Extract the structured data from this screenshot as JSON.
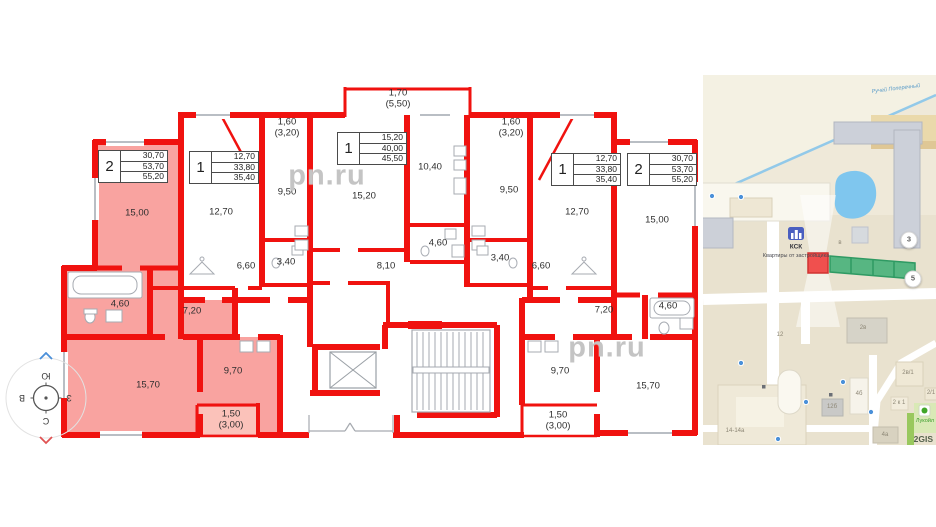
{
  "plan": {
    "watermark": "pn.ru",
    "apartments": [
      {
        "num": "2",
        "rows": [
          "30,70",
          "53,70",
          "55,20"
        ],
        "x": 98,
        "y": 150
      },
      {
        "num": "1",
        "rows": [
          "12,70",
          "33,80",
          "35,40"
        ],
        "x": 189,
        "y": 151
      },
      {
        "num": "1",
        "rows": [
          "15,20",
          "40,00",
          "45,50"
        ],
        "x": 337,
        "y": 132
      },
      {
        "num": "1",
        "rows": [
          "12,70",
          "33,80",
          "35,40"
        ],
        "x": 551,
        "y": 153
      },
      {
        "num": "2",
        "rows": [
          "30,70",
          "53,70",
          "55,20"
        ],
        "x": 627,
        "y": 153
      }
    ],
    "room_labels": [
      {
        "t": "15,00",
        "x": 137,
        "y": 213
      },
      {
        "t": "4,60",
        "x": 120,
        "y": 304
      },
      {
        "t": "7,20",
        "x": 192,
        "y": 311
      },
      {
        "t": "15,70",
        "x": 148,
        "y": 385
      },
      {
        "t": "9,70",
        "x": 233,
        "y": 371
      },
      {
        "t": "1,50\n(3,00)",
        "x": 231,
        "y": 420
      },
      {
        "t": "12,70",
        "x": 221,
        "y": 212
      },
      {
        "t": "9,50",
        "x": 287,
        "y": 192
      },
      {
        "t": "3,40",
        "x": 286,
        "y": 262
      },
      {
        "t": "6,60",
        "x": 246,
        "y": 266
      },
      {
        "t": "1,60\n(3,20)",
        "x": 287,
        "y": 128
      },
      {
        "t": "15,20",
        "x": 364,
        "y": 196
      },
      {
        "t": "10,40",
        "x": 430,
        "y": 167
      },
      {
        "t": "1,70\n(5,50)",
        "x": 398,
        "y": 99
      },
      {
        "t": "8,10",
        "x": 386,
        "y": 266
      },
      {
        "t": "4,60",
        "x": 438,
        "y": 243
      },
      {
        "t": "12,70",
        "x": 577,
        "y": 212
      },
      {
        "t": "9,50",
        "x": 509,
        "y": 190
      },
      {
        "t": "3,40",
        "x": 500,
        "y": 258
      },
      {
        "t": "6,60",
        "x": 541,
        "y": 266
      },
      {
        "t": "1,60\n(3,20)",
        "x": 511,
        "y": 128
      },
      {
        "t": "15,00",
        "x": 657,
        "y": 220
      },
      {
        "t": "4,60",
        "x": 668,
        "y": 306
      },
      {
        "t": "7,20",
        "x": 604,
        "y": 310
      },
      {
        "t": "9,70",
        "x": 560,
        "y": 371
      },
      {
        "t": "15,70",
        "x": 648,
        "y": 386
      },
      {
        "t": "1,50\n(3,00)",
        "x": 558,
        "y": 421
      }
    ]
  },
  "compass": {
    "top": "Ю",
    "left": "В",
    "right": "З",
    "bottom": "С"
  },
  "map": {
    "ksk_label": "КСК",
    "developer_label": "Квартиры от застройщика",
    "stream_label": "Ручей Поперечный",
    "lukoil_label": "Лукойл",
    "attribution": "2GIS",
    "badges": [
      {
        "t": "3",
        "x": 206,
        "y": 165
      },
      {
        "t": "5",
        "x": 210,
        "y": 204
      }
    ],
    "building_labels": [
      {
        "t": "12",
        "x": 77,
        "y": 260
      },
      {
        "t": "2в",
        "x": 160,
        "y": 253
      },
      {
        "t": "в",
        "x": 137,
        "y": 168
      },
      {
        "t": "14-14а",
        "x": 32,
        "y": 356
      },
      {
        "t": "12б",
        "x": 129,
        "y": 332
      },
      {
        "t": "4б",
        "x": 156,
        "y": 319
      },
      {
        "t": "2в/1",
        "x": 205,
        "y": 298
      },
      {
        "t": "2/1",
        "x": 228,
        "y": 318
      },
      {
        "t": "2 к 1",
        "x": 196,
        "y": 328
      },
      {
        "t": "4а",
        "x": 182,
        "y": 360
      }
    ]
  }
}
